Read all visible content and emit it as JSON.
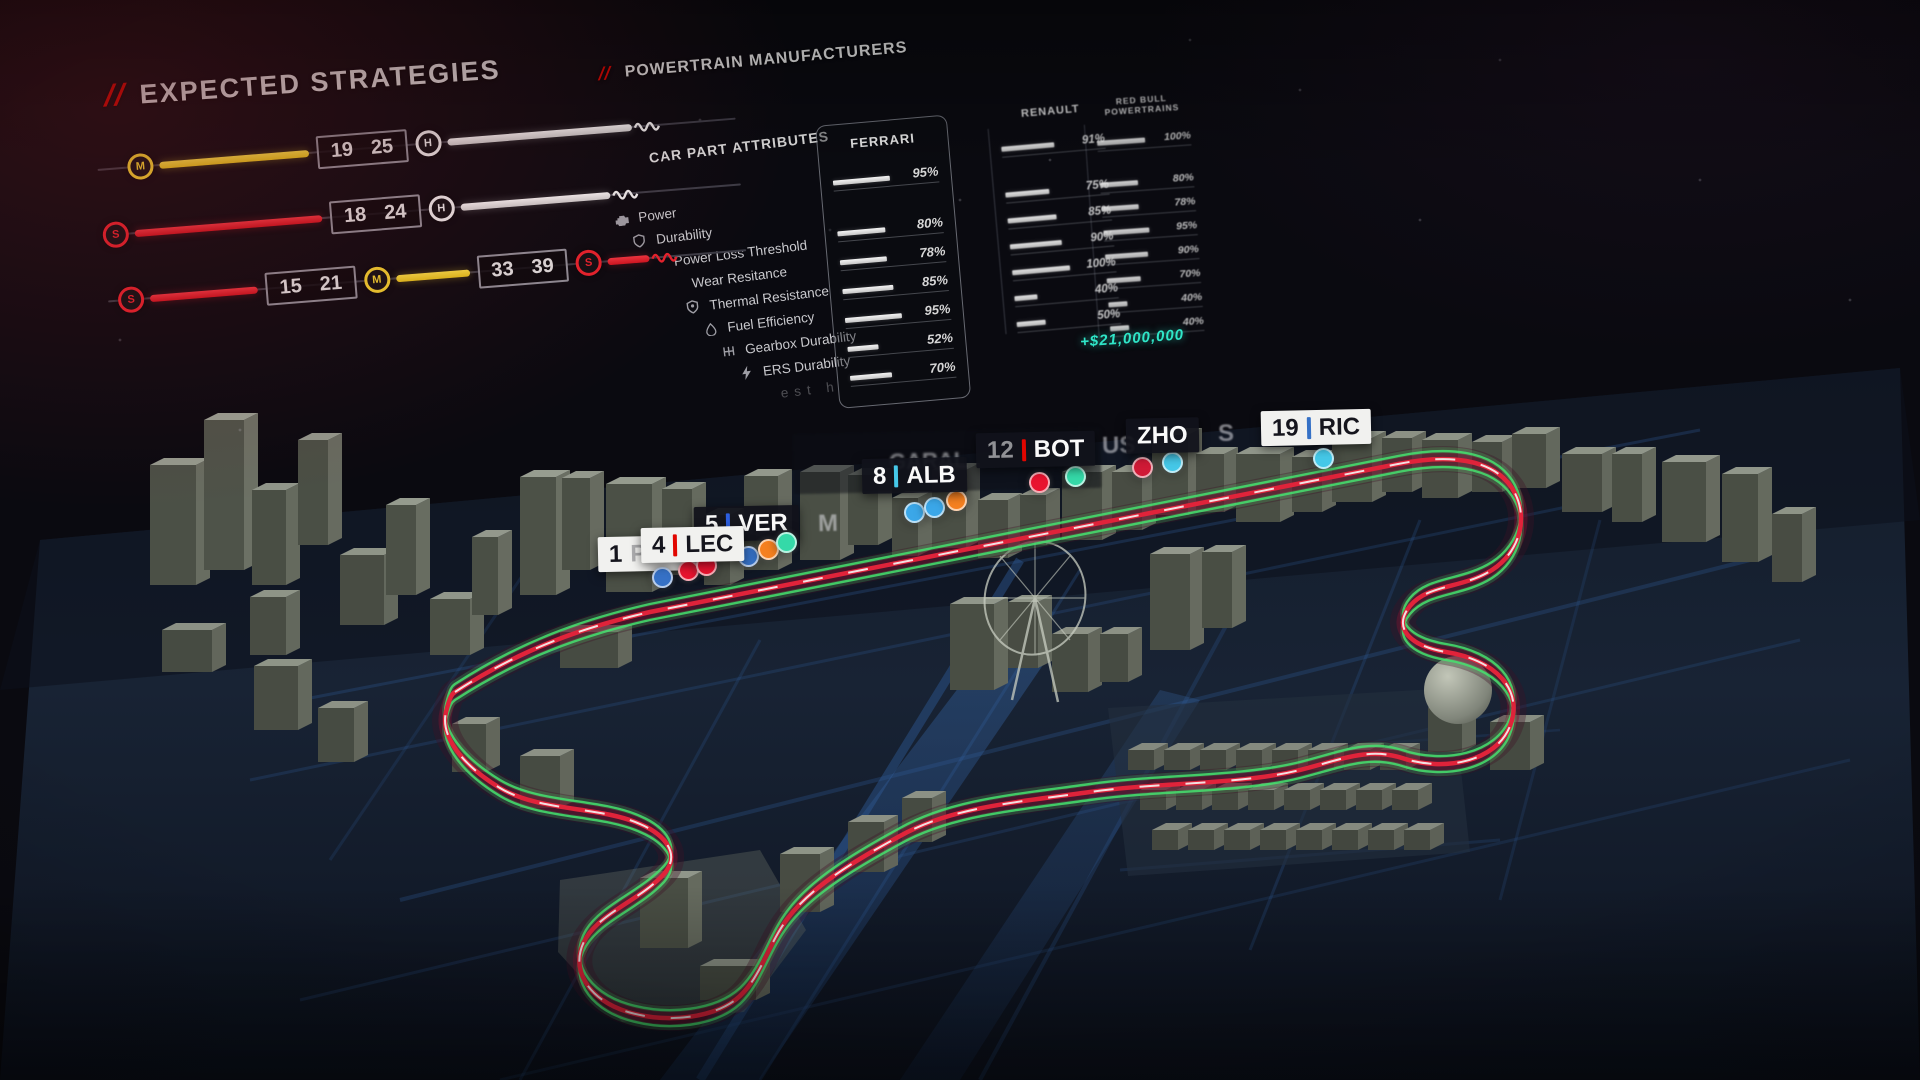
{
  "strategies": {
    "title_slashes": "//",
    "title": "EXPECTED STRATEGIES",
    "rows": {
      "r1": {
        "b1lo": "19",
        "b1hi": "25"
      },
      "r2": {
        "b1lo": "18",
        "b1hi": "24"
      },
      "r3": {
        "b1lo": "15",
        "b1hi": "21",
        "b2lo": "33",
        "b2hi": "39"
      }
    },
    "tire_colors": {
      "soft": "#e8222d",
      "medium": "#f2d230",
      "hard": "#ececec"
    }
  },
  "powertrain": {
    "title_slashes": "//",
    "title": "POWERTRAIN MANUFACTURERS",
    "attributes_header": "CAR PART ATTRIBUTES",
    "attributes": [
      {
        "label": "Power"
      },
      {
        "label": "Durability"
      },
      {
        "label": "Power Loss Threshold"
      },
      {
        "label": "Wear Resitance"
      },
      {
        "label": "Thermal Resistance"
      },
      {
        "label": "Fuel Efficiency"
      },
      {
        "label": "Gearbox Durability"
      },
      {
        "label": "ERS Durability"
      }
    ],
    "attribute_fragment": "est h",
    "manufacturers": [
      {
        "name": "FERRARI",
        "selected": true,
        "overall_label": "95%",
        "overall": 95,
        "rows": [
          {
            "v": 80,
            "label": "80%"
          },
          {
            "v": 78,
            "label": "78%"
          },
          {
            "v": 85,
            "label": "85%"
          },
          {
            "v": 95,
            "label": "95%"
          },
          {
            "v": 52,
            "label": "52%"
          },
          {
            "v": 70,
            "label": "70%"
          }
        ]
      },
      {
        "name": "RENAULT",
        "selected": false,
        "overall_label": "91%",
        "overall": 91,
        "rows": [
          {
            "v": 75,
            "label": "75%"
          },
          {
            "v": 85,
            "label": "85%"
          },
          {
            "v": 90,
            "label": "90%"
          },
          {
            "v": 100,
            "label": "100%"
          },
          {
            "v": 40,
            "label": "40%"
          },
          {
            "v": 50,
            "label": "50%"
          }
        ]
      },
      {
        "name": "RED BULL POWERTRAINS",
        "selected": false,
        "overall_label": "100%",
        "overall": 100,
        "rows": [
          {
            "v": 80,
            "label": "80%"
          },
          {
            "v": 78,
            "label": "78%"
          },
          {
            "v": 95,
            "label": "95%"
          },
          {
            "v": 90,
            "label": "90%"
          },
          {
            "v": 70,
            "label": "70%"
          },
          {
            "v": 40,
            "label": "40%"
          },
          {
            "v": 40,
            "label": "40%"
          }
        ]
      }
    ],
    "money": "+$21,000,000"
  },
  "map": {
    "labels": {
      "per_partial": {
        "number": "1",
        "ghost_name": "PER"
      },
      "lec": {
        "number": "4",
        "name": "LEC",
        "sep_color": "#e10600"
      },
      "ver": {
        "number": "5",
        "name": "VER",
        "sep_color": "#2d5fe0"
      },
      "ver_ghost": "M",
      "alb": {
        "number": "8",
        "name": "ALB",
        "sep_color": "#46c8e8"
      },
      "garal_ghost": "GARAL",
      "bot": {
        "number": "12",
        "name": "BOT",
        "sep_color": "#e10600"
      },
      "rus_ghost": "US",
      "zho": {
        "name": "ZHO"
      },
      "s_ghost": "S",
      "ric": {
        "number": "19",
        "name": "RIC",
        "sep_color": "#3671c6"
      }
    },
    "cars": [
      {
        "team_color": "#3671C6",
        "x": 662,
        "y": 577
      },
      {
        "team_color": "#E8132F",
        "x": 688,
        "y": 570
      },
      {
        "team_color": "#E8132F",
        "x": 706,
        "y": 565
      },
      {
        "team_color": "#3671C6",
        "x": 748,
        "y": 556
      },
      {
        "team_color": "#F58020",
        "x": 768,
        "y": 549
      },
      {
        "team_color": "#35D9A8",
        "x": 786,
        "y": 542
      },
      {
        "team_color": "#3BA7E8",
        "x": 914,
        "y": 512
      },
      {
        "team_color": "#3BA7E8",
        "x": 934,
        "y": 507
      },
      {
        "team_color": "#F58020",
        "x": 956,
        "y": 500
      },
      {
        "team_color": "#E8132F",
        "x": 1039,
        "y": 482
      },
      {
        "team_color": "#35D9A8",
        "x": 1075,
        "y": 476
      },
      {
        "team_color": "#D01A36",
        "x": 1142,
        "y": 467
      },
      {
        "team_color": "#45C8E8",
        "x": 1172,
        "y": 462
      },
      {
        "team_color": "#45C8E8",
        "x": 1323,
        "y": 458
      }
    ],
    "colors": {
      "track_red": "#E0233A",
      "track_green": "#47E06E",
      "road_blue": "#2E5A96"
    }
  }
}
